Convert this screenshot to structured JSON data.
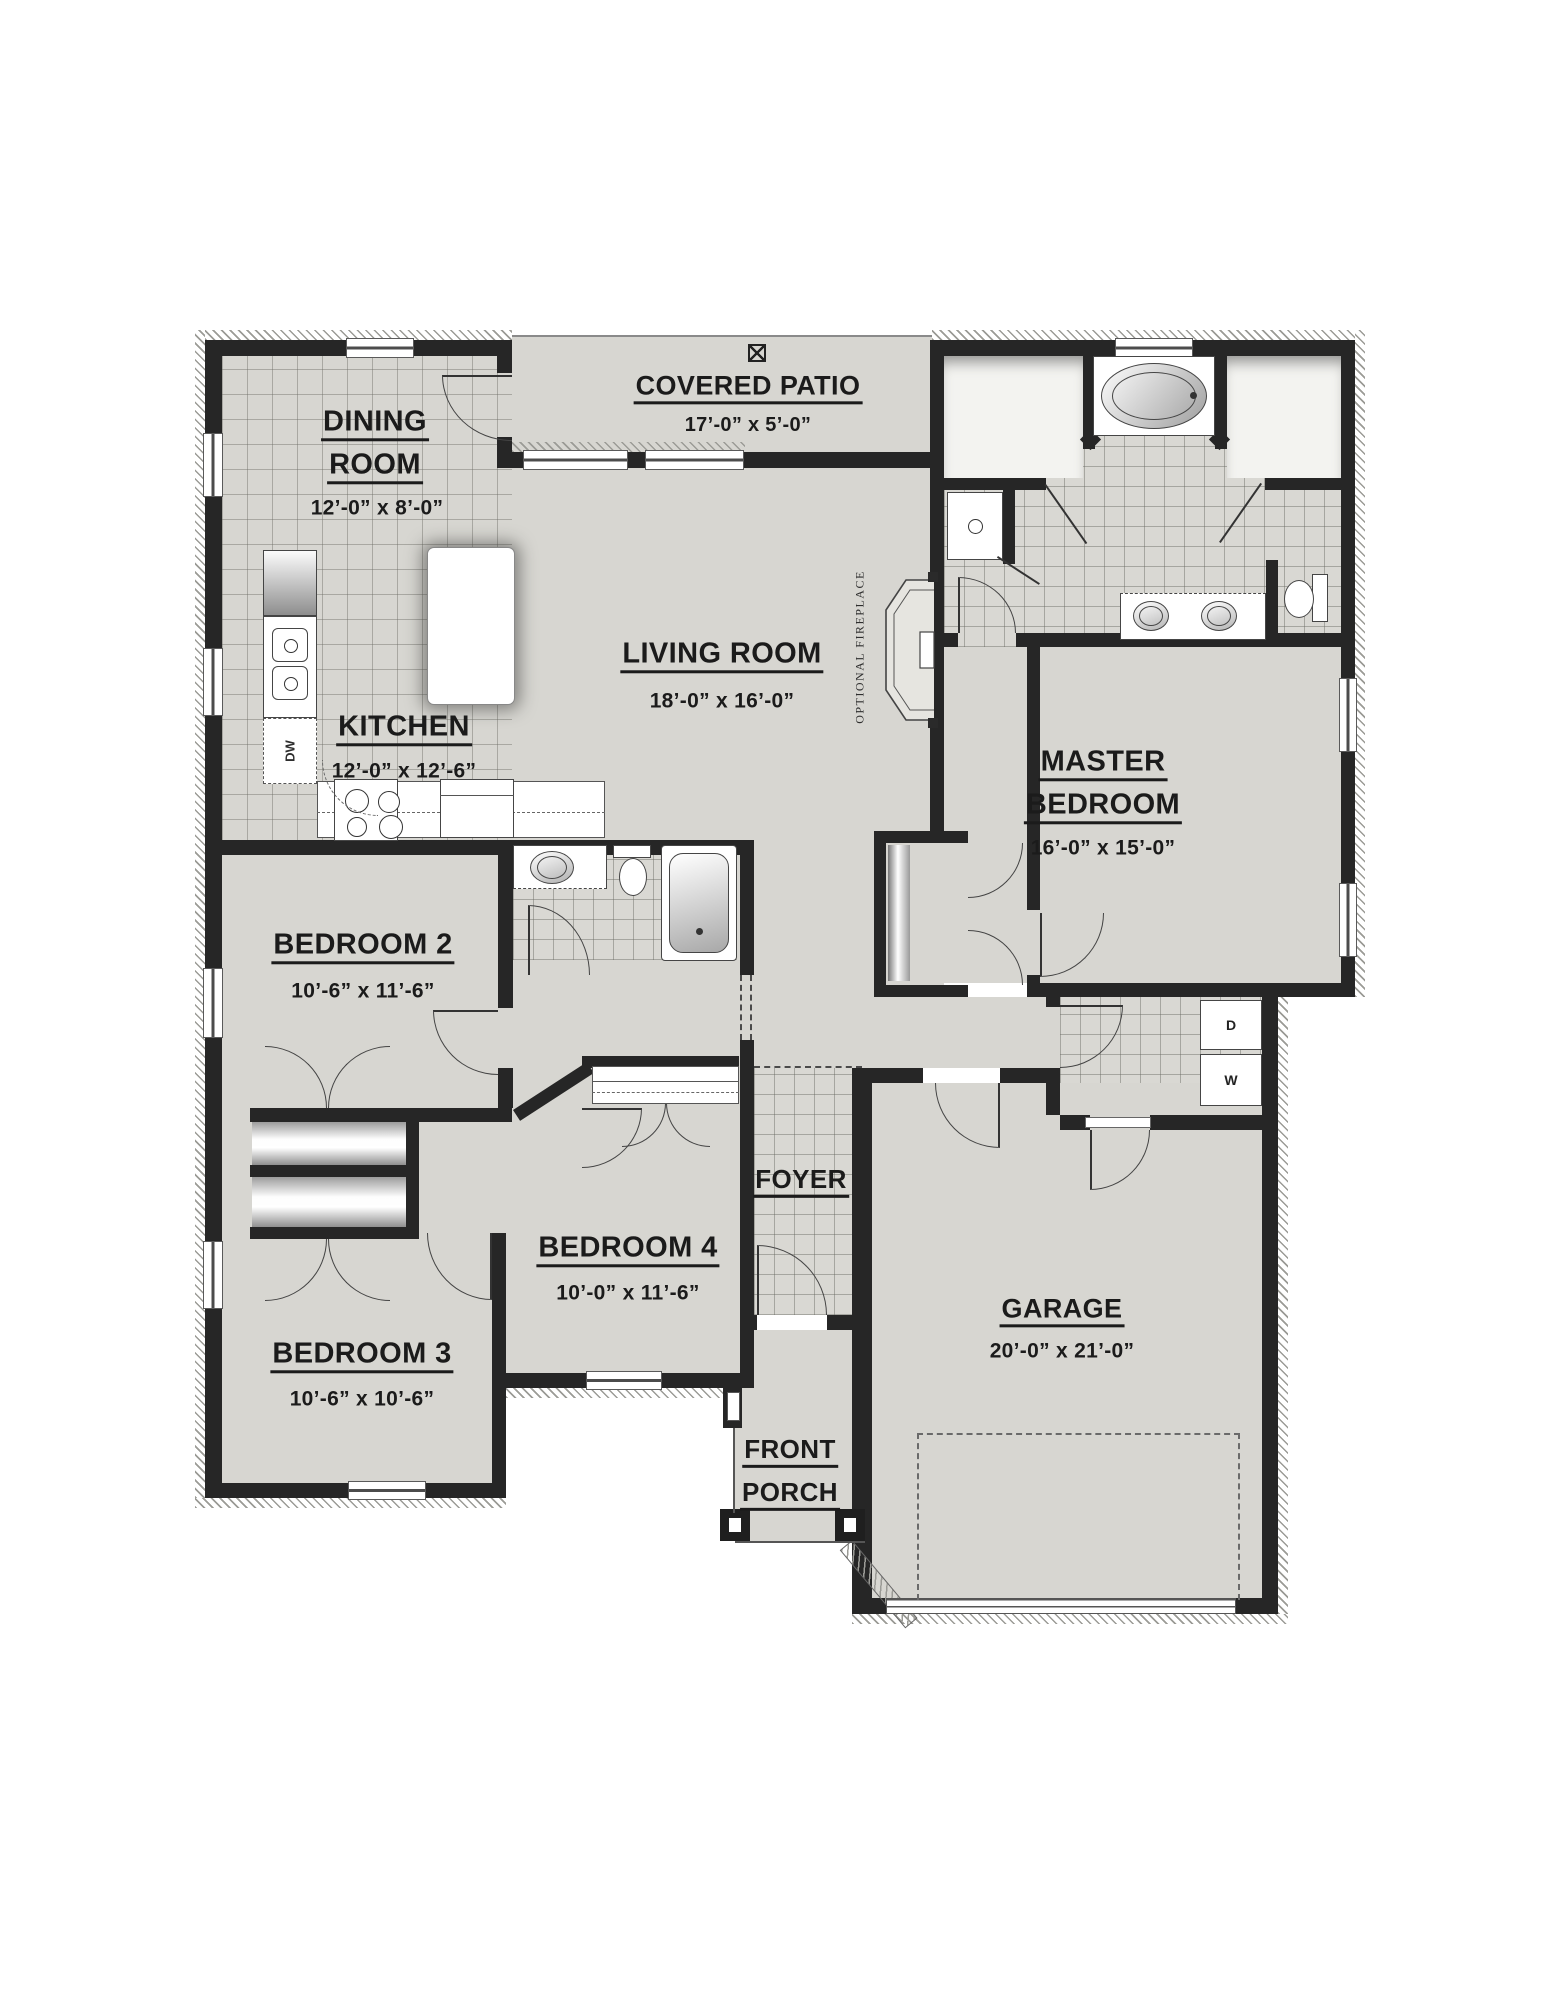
{
  "rooms": {
    "dining": {
      "line1": "DINING",
      "line2": "ROOM",
      "dims": "12’-0” x 8’-0”"
    },
    "patio": {
      "line1": "COVERED PATIO",
      "dims": "17’-0” x 5’-0”"
    },
    "living": {
      "line1": "LIVING ROOM",
      "dims": "18’-0” x 16’-0”"
    },
    "kitchen": {
      "line1": "KITCHEN",
      "dims": "12’-0” x 12’-6”"
    },
    "master": {
      "line1": "MASTER",
      "line2": "BEDROOM",
      "dims": "16’-0” x 15’-0”"
    },
    "bedroom2": {
      "line1": "BEDROOM 2",
      "dims": "10’-6” x 11’-6”"
    },
    "bedroom3": {
      "line1": "BEDROOM 3",
      "dims": "10’-6” x 10’-6”"
    },
    "bedroom4": {
      "line1": "BEDROOM 4",
      "dims": "10’-0” x 11’-6”"
    },
    "foyer": {
      "line1": "FOYER"
    },
    "garage": {
      "line1": "GARAGE",
      "dims": "20’-0” x 21’-0”"
    },
    "porch": {
      "line1": "FRONT",
      "line2": "PORCH"
    }
  },
  "annotations": {
    "optional_fireplace": "OPTIONAL FIREPLACE",
    "dryer": "D",
    "washer": "W",
    "dishwasher": "DW",
    "patio_symbol": "⊠"
  },
  "colors": {
    "wall": "#262626",
    "floor": "#d7d6d1",
    "tile_line": "#8f8f89"
  }
}
